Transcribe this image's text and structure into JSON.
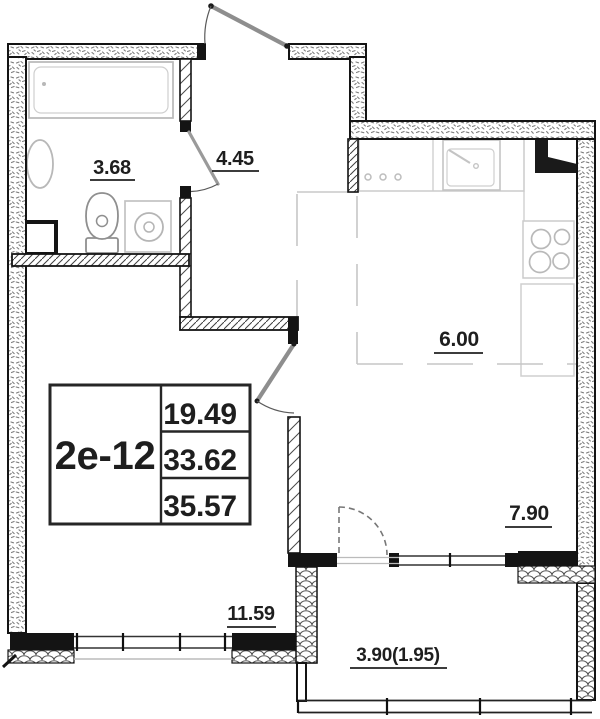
{
  "plan": {
    "info_box": {
      "unit": "2е-12",
      "values": [
        "19.49",
        "33.62",
        "35.57"
      ]
    },
    "rooms": {
      "bathroom": {
        "area": "3.68"
      },
      "hallway": {
        "area": "4.45"
      },
      "kitchen": {
        "area": "6.00"
      },
      "room": {
        "area": "7.90"
      },
      "living_room": {
        "area": "11.59"
      },
      "balcony": {
        "area": "3.90(1.95)"
      }
    },
    "colors": {
      "wall": "#141414",
      "furniture": "#c2c2c2",
      "text": "#1e1e1e",
      "door": "#8e8e8e"
    }
  }
}
